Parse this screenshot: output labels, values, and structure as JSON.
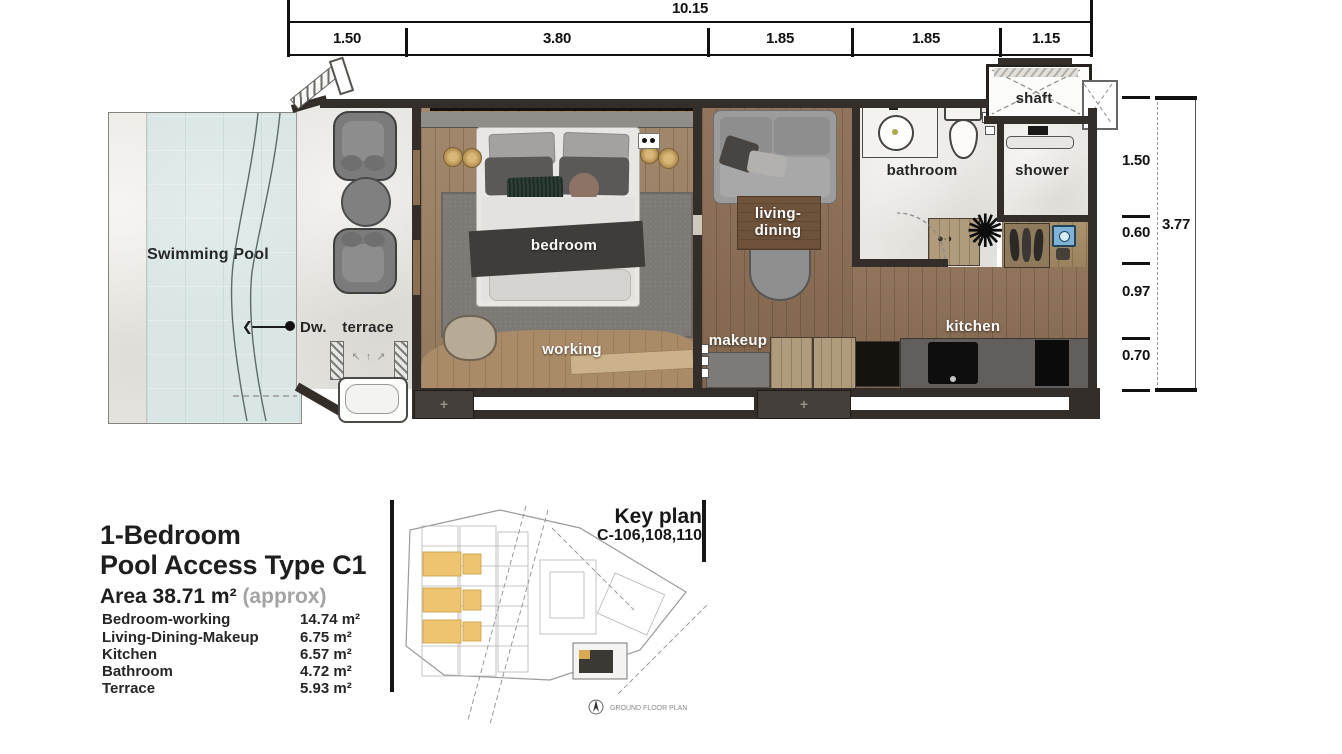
{
  "dims_top": {
    "overall": "10.15",
    "segments": [
      "1.50",
      "3.80",
      "1.85",
      "1.85",
      "1.15"
    ]
  },
  "dims_right": {
    "overall": "3.77",
    "segments": [
      "1.50",
      "0.60",
      "0.97",
      "0.70"
    ]
  },
  "plan": {
    "swimming_pool": "Swimming Pool",
    "dw": "Dw.",
    "arrow_char": "❮",
    "terrace": "terrace",
    "bedroom": "bedroom",
    "working": "working",
    "living_line1": "living-",
    "living_line2": "dining",
    "makeup": "makeup",
    "bathroom": "bathroom",
    "shower": "shower",
    "shaft": "shaft",
    "kitchen": "kitchen",
    "post_mark": "+",
    "vent_arrows": "↖ ↑ ↗"
  },
  "title_block": {
    "title_line1": "1-Bedroom",
    "title_line2": "Pool Access  Type  C1",
    "area_label": "Area  38.71 m²",
    "area_qualifier": "(approx)",
    "rooms": [
      {
        "name": "Bedroom-working",
        "area": "14.74 m²"
      },
      {
        "name": "Living-Dining-Makeup",
        "area": "6.75 m²"
      },
      {
        "name": "Kitchen",
        "area": "6.57 m²"
      },
      {
        "name": "Bathroom",
        "area": "4.72 m²"
      },
      {
        "name": "Terrace",
        "area": "5.93 m²"
      }
    ]
  },
  "key_plan": {
    "title": "Key plan",
    "unit_code": "C-106,108,110",
    "caption": "GROUND  FLOOR  PLAN"
  },
  "colors": {
    "wall": "#332e2a",
    "pool_water": "#d9e6e5",
    "wood_bedroom": "#9d8164",
    "wood_living": "#8b6d53",
    "highlight_units": "#edc571"
  }
}
